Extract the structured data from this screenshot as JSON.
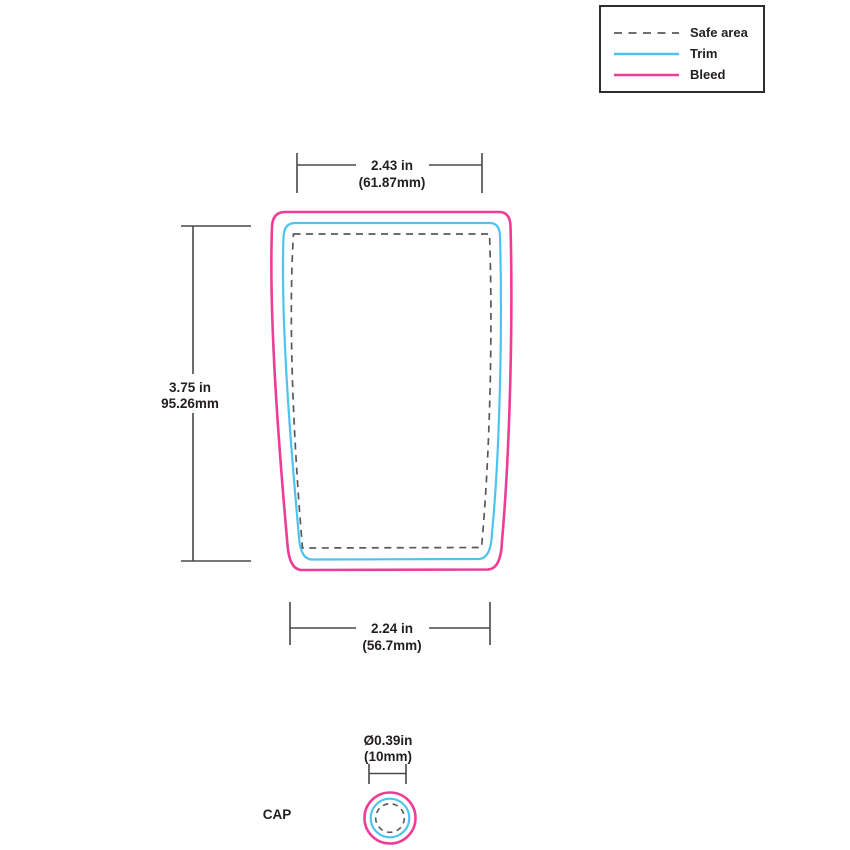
{
  "legend": {
    "items": [
      {
        "id": "safe-area",
        "label": "Safe area"
      },
      {
        "id": "trim",
        "label": "Trim"
      },
      {
        "id": "bleed",
        "label": "Bleed"
      }
    ]
  },
  "colors": {
    "bleed": "#ee3d96",
    "trim": "#4ec3f0",
    "safe_area": "#58595b",
    "dimension_lines": "#47484a",
    "text": "#231f20"
  },
  "dimensions": {
    "top_width": {
      "primary": "2.43 in",
      "secondary": "(61.87mm)"
    },
    "height": {
      "primary": "3.75 in",
      "secondary": "95.26mm"
    },
    "bottom_width": {
      "primary": "2.24 in",
      "secondary": "(56.7mm)"
    },
    "cap_diameter": {
      "primary": "Ø0.39in",
      "secondary": "(10mm)"
    }
  },
  "labels": {
    "cap": "CAP"
  }
}
